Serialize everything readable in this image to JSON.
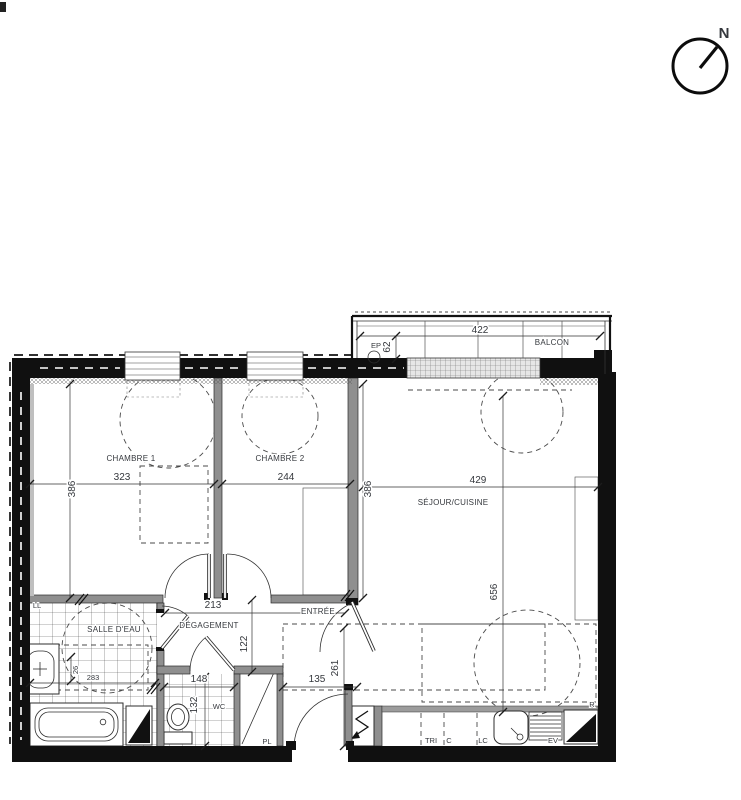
{
  "compass": {
    "north": "N"
  },
  "rooms": {
    "chambre1": "CHAMBRE 1",
    "chambre2": "CHAMBRE 2",
    "sejour_cuisine": "SÉJOUR/CUISINE",
    "salle_deau": "SALLE D'EAU",
    "degagement": "DÉGAGEMENT",
    "entree": "ENTRÉE",
    "balcon": "BALCON",
    "wc": "WC",
    "placard": "PL"
  },
  "dimensions_cm": {
    "balcon_width": "422",
    "balcon_depth": "62",
    "chambre1_width": "323",
    "chambre1_depth": "386",
    "chambre2_width": "244",
    "chambre2_depth": "386",
    "sejour_width": "429",
    "sejour_depth": "656",
    "degagement_width": "213",
    "degagement_clearance": "122",
    "wc_width": "148",
    "wc_depth": "132",
    "entree_width": "135",
    "entree_depth": "261",
    "salle_deau_small": "26",
    "salle_deau_width": "283"
  },
  "equipment_labels": {
    "ll": "LL",
    "ep": "EP",
    "tri": "TRI",
    "c": "C",
    "lc": "LC",
    "ev": "EV",
    "r": "R"
  },
  "colors": {
    "wall": "#101010",
    "line": "#333333",
    "text": "#35383d"
  }
}
